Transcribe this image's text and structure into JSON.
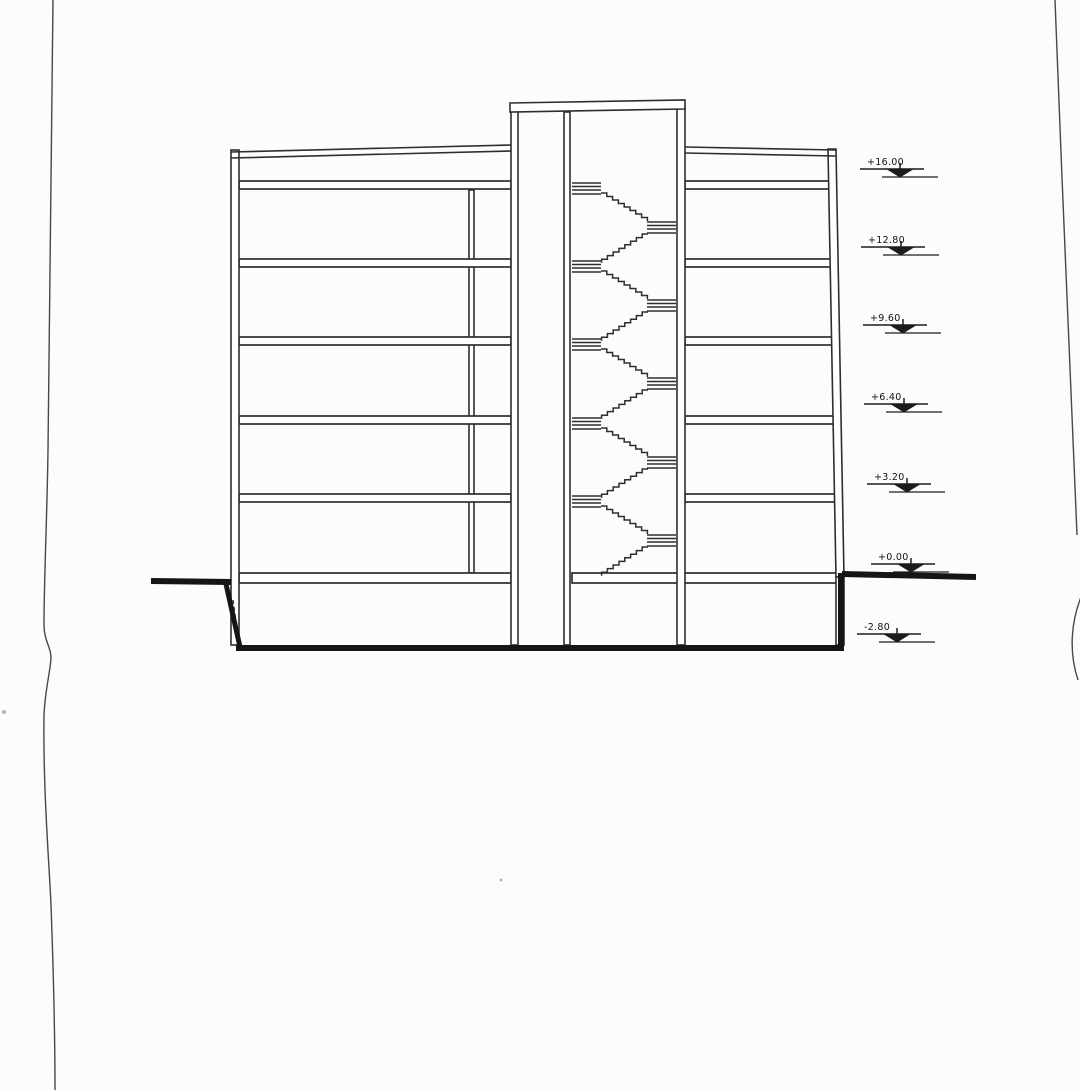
{
  "drawing": {
    "paper_color": "#fcfcfb",
    "ink_color": "#2e2e2e",
    "ground_ink_color": "#151515",
    "levels": [
      {
        "label": "+16.00"
      },
      {
        "label": "+12.80"
      },
      {
        "label": "+9.60"
      },
      {
        "label": "+6.40"
      },
      {
        "label": "+3.20"
      },
      {
        "label": "+0.00"
      },
      {
        "label": "-2.80"
      }
    ]
  }
}
